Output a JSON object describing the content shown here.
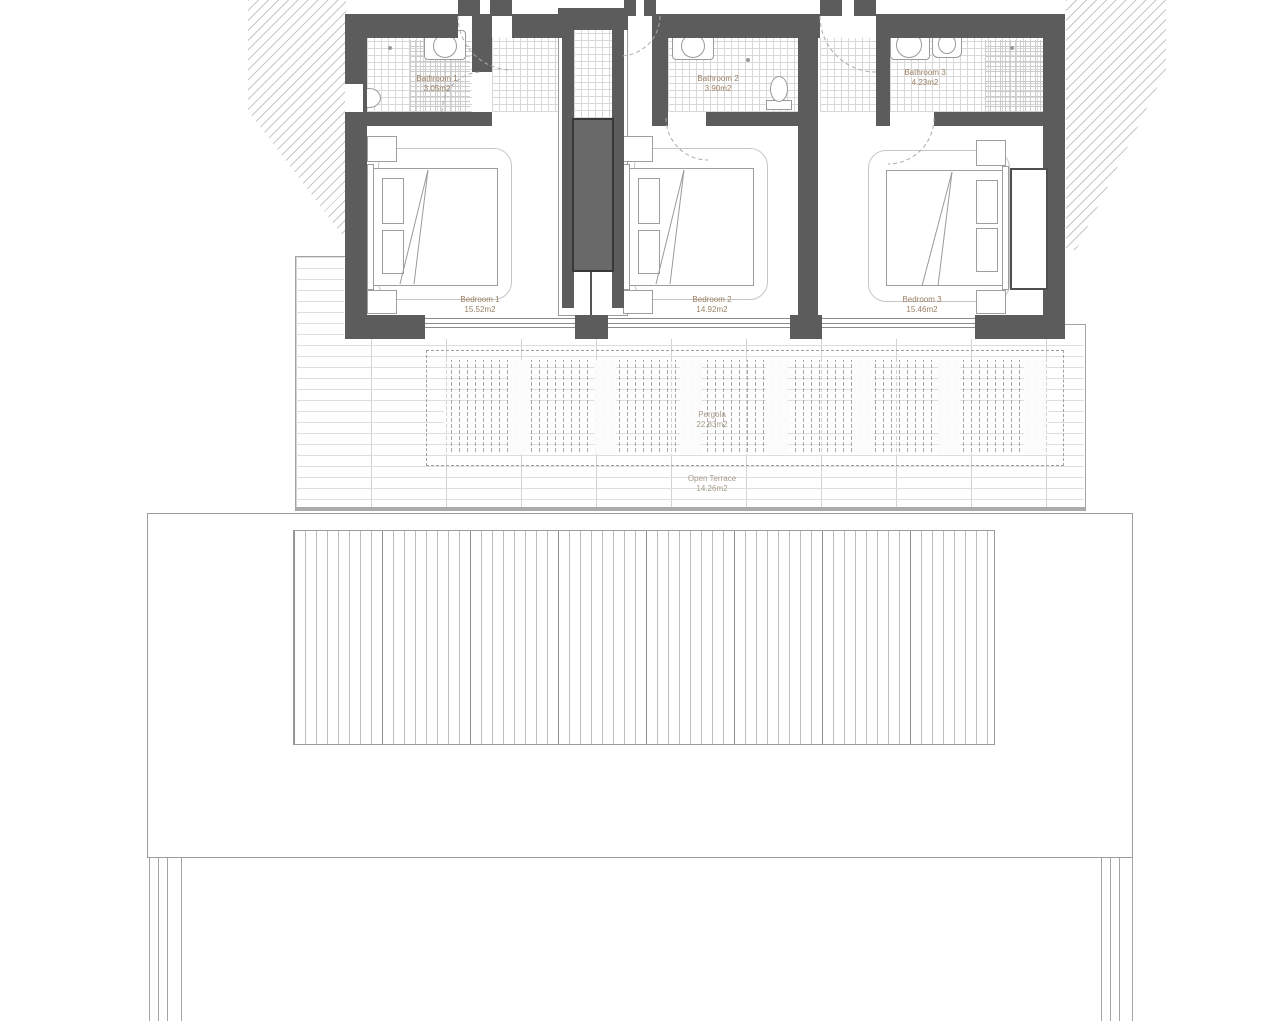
{
  "rooms": [
    {
      "name": "Bathroom 1",
      "area": "3.05m2"
    },
    {
      "name": "Bathroom 2",
      "area": "3.90m2"
    },
    {
      "name": "Bathroom 3",
      "area": "4.23m2"
    },
    {
      "name": "Bedroom 1",
      "area": "15.52m2"
    },
    {
      "name": "Bedroom 2",
      "area": "14.92m2"
    },
    {
      "name": "Bedroom 3",
      "area": "15.46m2"
    },
    {
      "name": "Pergola",
      "area": "22.83m2"
    },
    {
      "name": "Open Terrace",
      "area": "14.26m2"
    }
  ],
  "colors": {
    "wall": "#5c5c5c",
    "room_label_text": "#9c8065",
    "terrace_label_text": "#a49b8b",
    "outline": "#9b9b9b"
  }
}
